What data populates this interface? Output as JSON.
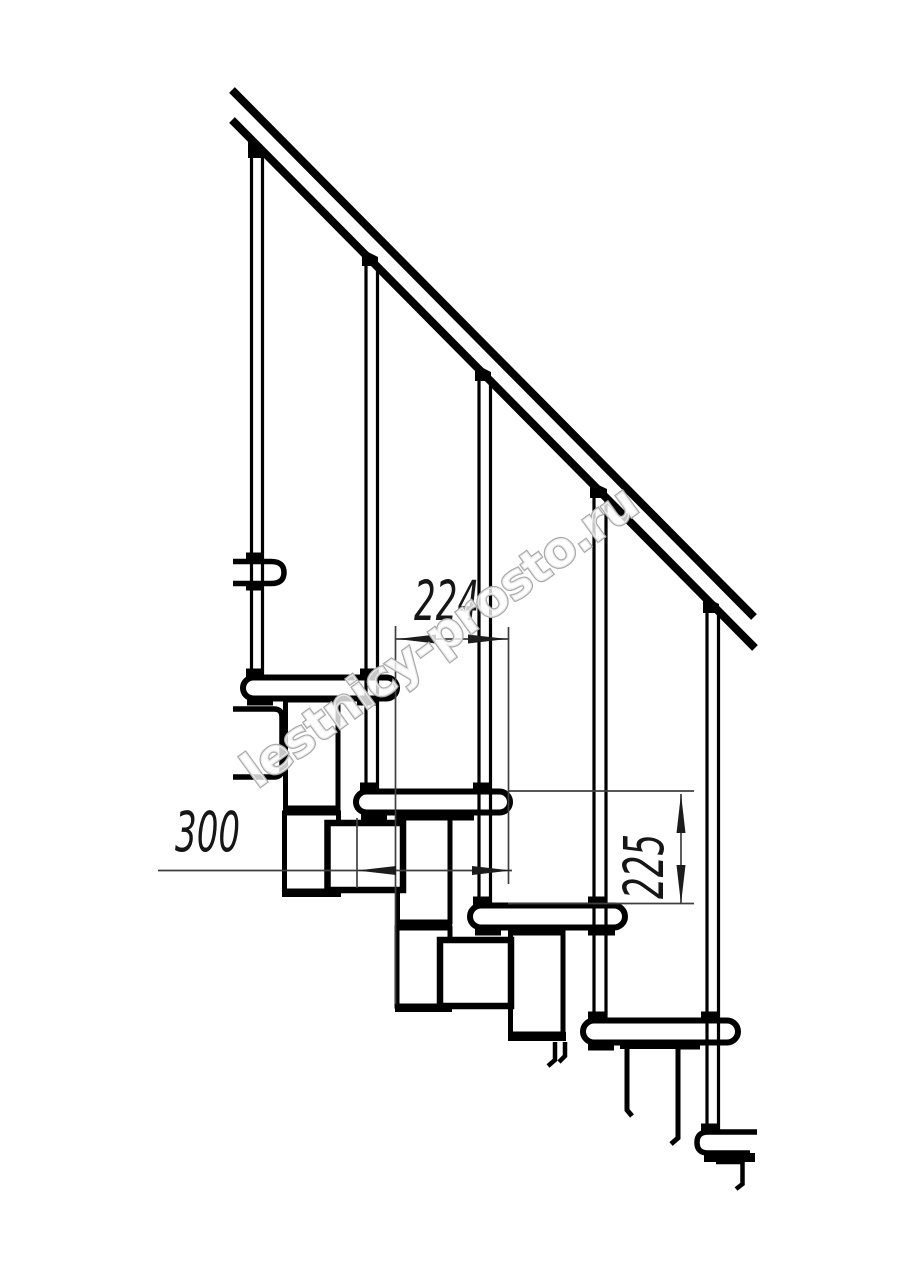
{
  "drawing": {
    "subject": "modular staircase side view",
    "labels": {
      "run": "224",
      "depth": "300",
      "rise": "225"
    },
    "watermark": "lestnicy-prosto.ru",
    "counts": {
      "balusters": 5,
      "treads_full": 4,
      "tread_fragments": 2
    },
    "colors": {
      "line": "#000000",
      "dimension": "#3f3f3f",
      "dimension_fill": "#1c1c1c",
      "watermark_stroke": "#a9a9a9",
      "background": "#ffffff"
    }
  }
}
